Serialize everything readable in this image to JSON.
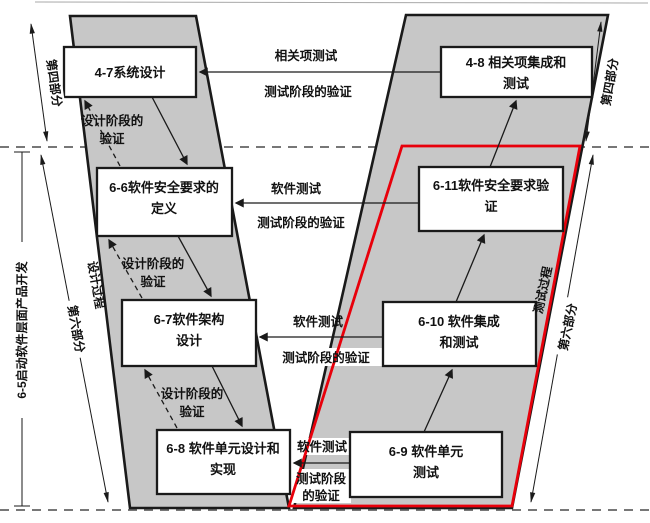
{
  "diagram": {
    "boxes": {
      "b47": {
        "l1": "4-7系统设计"
      },
      "b48": {
        "l1": "4-8 相关项集成和",
        "l2": "测试"
      },
      "b66": {
        "l1": "6-6软件安全要求的",
        "l2": "定义"
      },
      "b67": {
        "l1": "6-7软件架构",
        "l2": "设计"
      },
      "b68": {
        "l1": "6-8 软件单元设计和",
        "l2": "实现"
      },
      "b69": {
        "l1": "6-9 软件单元",
        "l2": "测试"
      },
      "b610": {
        "l1": "6-10 软件集成",
        "l2": "和测试"
      },
      "b611": {
        "l1": "6-11软件安全要求验",
        "l2": "证"
      }
    },
    "flow_labels": {
      "item_test": "相关项测试",
      "test_phase_verify_top": "测试阶段的验证",
      "sw_test_1": "软件测试",
      "test_phase_verify_1": "测试阶段的验证",
      "sw_test_2": "软件测试",
      "test_phase_verify_2": "测试阶段的验证",
      "sw_test_3": "软件测试",
      "test_phase_verify_3a": "测试阶段",
      "test_phase_verify_3b": "的验证",
      "design_phase_verify_a": "设计阶段的",
      "design_phase_verify_b": "验证"
    },
    "side_labels": {
      "part4_left": "第四部分",
      "part6_left": "第六部分",
      "design_process": "设计过程",
      "part4_right": "第四部分",
      "part6_right": "第六部分",
      "test_process": "测试过程",
      "sw_level_dev": "6-5启动软件层面产品开发"
    },
    "colors": {
      "band": "#c7c7c7",
      "line": "#1a1a1a",
      "highlight": "#e8000b"
    }
  }
}
